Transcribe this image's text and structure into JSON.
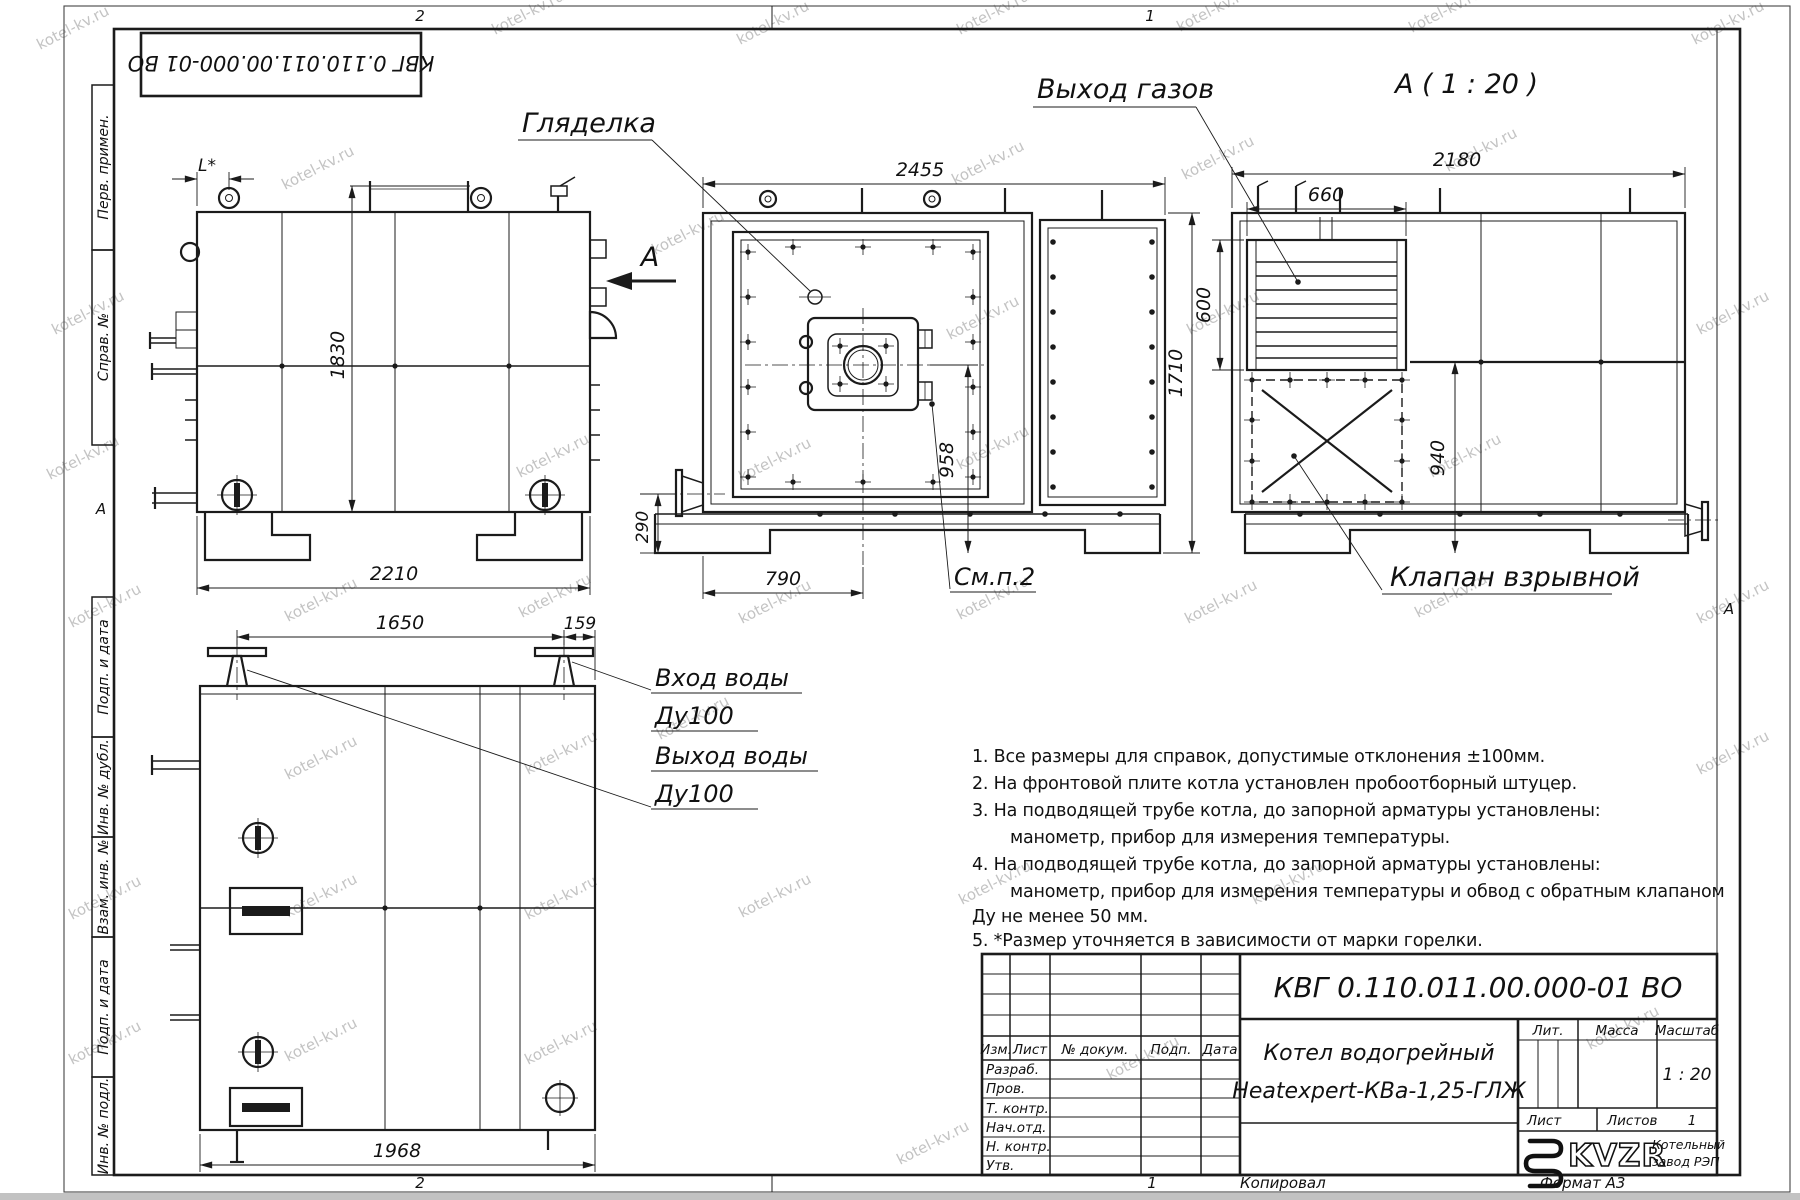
{
  "watermark": "kotel-kv.ru",
  "doc_box_number": "КВГ 0.110.011.00.000-01 ВО",
  "margins": {
    "zone_top_left": "2",
    "zone_top_right": "1",
    "zone_bottom_left": "2",
    "zone_bottom_right": "1",
    "zone_letter_left": "А",
    "zone_letter_right": "А",
    "copied_label": "Копировал",
    "format_label": "Формат А3"
  },
  "sidebar": {
    "items": [
      {
        "label": "Перв. примен."
      },
      {
        "label": "Справ. №"
      },
      {
        "label": "Подп. и дата"
      },
      {
        "label": "Инв. № дубл."
      },
      {
        "label": "Взам. инв. №"
      },
      {
        "label": "Подп. и дата"
      },
      {
        "label": "Инв. № подл."
      }
    ]
  },
  "views": {
    "side": {
      "dim_l": "L*",
      "dim_height": "1830",
      "dim_length": "2210",
      "view_arrow": "А"
    },
    "front": {
      "label_sight_glass": "Гляделка",
      "dim_width": "2455",
      "dim_height": "1710",
      "dim_burner_axis": "958",
      "dim_base": "290",
      "dim_burner_offset": "790",
      "label_see_note": "См.п.2"
    },
    "rear": {
      "title": "А ( 1 : 20 )",
      "label_gas_outlet": "Выход газов",
      "label_explosion_valve": "Клапан взрывной",
      "dim_width": "2180",
      "dim_grille_width": "660",
      "dim_grille_height": "600",
      "dim_valve_axis": "940"
    },
    "top": {
      "dim_nozzle_span": "1650",
      "dim_nozzle_edge": "159",
      "dim_length": "1968",
      "label_inlet_1": "Вход воды",
      "label_inlet_2": "Ду100",
      "label_outlet_1": "Выход воды",
      "label_outlet_2": "Ду100"
    }
  },
  "notes": [
    {
      "text": "1. Все размеры для справок, допустимые отклонения ±100мм."
    },
    {
      "text": "2. На фронтовой плите котла установлен пробоотборный штуцер."
    },
    {
      "text": "3. На подводящей трубе котла, до запорной арматуры установлены:"
    },
    {
      "text": "манометр, прибор для измерения температуры."
    },
    {
      "text": "4. На подводящей трубе котла, до запорной арматуры установлены:"
    },
    {
      "text": "манометр, прибор для измерения температуры и обвод с обратным клапаном"
    },
    {
      "text": "Ду не менее 50 мм."
    },
    {
      "text": "5. *Размер уточняется в зависимости от марки горелки."
    }
  ],
  "title_block": {
    "doc_number": "КВГ 0.110.011.00.000-01 ВО",
    "product_line1": "Котел водогрейный",
    "product_line2": "Heatexpert-КВа-1,25-ГЛЖ",
    "headers": {
      "izm": "Изм.",
      "list": "Лист",
      "doc": "№ докум.",
      "podp": "Подп.",
      "data": "Дата"
    },
    "rows": [
      {
        "label": "Разраб."
      },
      {
        "label": "Пров."
      },
      {
        "label": "Т. контр."
      },
      {
        "label": "Нач.отд."
      },
      {
        "label": "Н. контр."
      },
      {
        "label": "Утв."
      }
    ],
    "lit_label": "Лит.",
    "mass_label": "Масса",
    "scale_label": "Масштаб",
    "scale_value": "1 : 20",
    "sheet_label": "Лист",
    "sheets_label": "Листов",
    "sheets_value": "1",
    "logo_text": "KVZR",
    "company_line1": "Котельный",
    "company_line2": "завод РЭП"
  }
}
